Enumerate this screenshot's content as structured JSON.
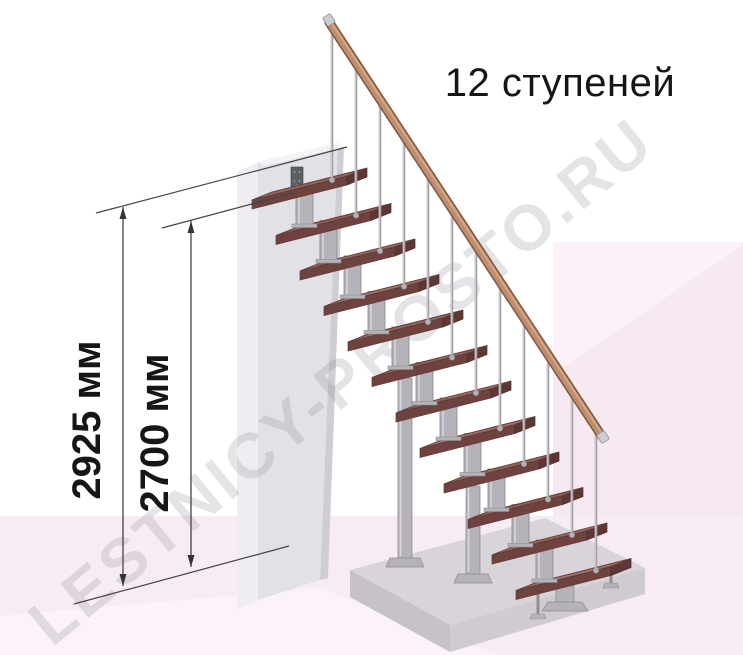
{
  "title": {
    "text": "12 ступеней"
  },
  "watermark": {
    "text": "LESTNICY-PROSTO.RU"
  },
  "dimensions": {
    "total_height": {
      "label": "2925 мм",
      "value": 2925,
      "unit": "мм"
    },
    "to_top_step": {
      "label": "2700 мм",
      "value": 2700,
      "unit": "мм"
    }
  },
  "stairs": {
    "steps_count": 12
  },
  "colors": {
    "wood_top": "#976760",
    "wood_front": "#6e423e",
    "wood_side": "#5c3733",
    "metal": "#b5b3b9",
    "metal_dark": "#8f8d93",
    "metal_light": "#dcdade",
    "baluster": "#a6a4aa",
    "rail": "#bf8e70",
    "rail_dark": "#81573f",
    "rail_light": "#d6ab8c",
    "cap": "#cbcbd0",
    "wall_front": "#e2e1e6",
    "wall_left": "#efedf2",
    "wall_top": "#f4f2f5",
    "wall_right": "#cfccd4",
    "bracket": "#5c6065",
    "platform_top": "#d8d4da",
    "platform_front": "#c6c2c8",
    "platform_right": "#cfcbd1",
    "floor_pink": "#f7ecf4",
    "floor_pink_light": "#fbf3f9",
    "deco_pink_light": "#fbf1f8",
    "deco_pink_deep": "#f6e9f1",
    "dim_line": "#444444",
    "dim_arrow": "#333333",
    "text": "#151515"
  }
}
